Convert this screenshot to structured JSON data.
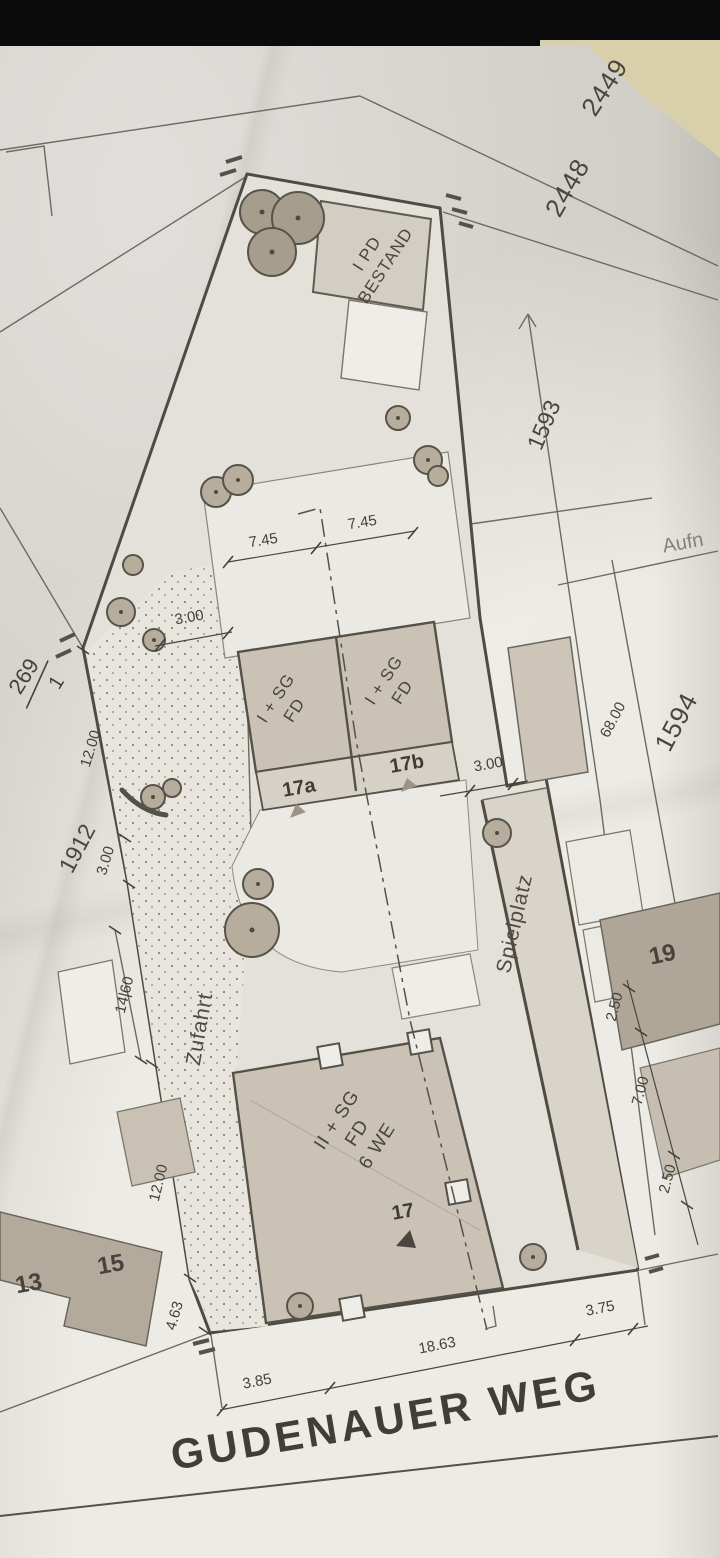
{
  "plan": {
    "street": "GUDENAUER WEG",
    "areas": {
      "driveway": "Zufahrt",
      "playground": "Spielplatz",
      "margin_note": "Aufn"
    },
    "buildings": {
      "bestand": {
        "l1": "I PD",
        "l2": "BESTAND"
      },
      "h17a": {
        "l1": "I + SG",
        "l2": "FD",
        "no": "17a"
      },
      "h17b": {
        "l1": "I + SG",
        "l2": "FD",
        "no": "17b"
      },
      "h17": {
        "l1": "II + SG",
        "l2": "FD",
        "l3": "6 WE",
        "no": "17"
      },
      "h19": {
        "no": "19"
      },
      "h13": {
        "no": "13"
      },
      "h15": {
        "no": "15"
      }
    },
    "parcels": {
      "p2449": "2449",
      "p2448": "2448",
      "p1593": "1593",
      "p1594": "1594",
      "p1912": "1912",
      "p269_num": "269",
      "p269_den": "1"
    },
    "dims": {
      "d745a": "7.45",
      "d745b": "7.45",
      "d300a": "3.00",
      "d300b": "3.00",
      "d300c": "3.00",
      "d1200a": "12.00",
      "d1200b": "12.00",
      "d1460": "14|60",
      "d463": "4.63",
      "d385": "3.85",
      "d1863": "18.63",
      "d375": "3.75",
      "d250a": "2.50",
      "d700": "7.00",
      "d250b": "2.50",
      "d6800": "68.00"
    },
    "colors": {
      "paper": "#edebe5",
      "desk": "#d8d0ab",
      "top_band": "#0b0b0b",
      "plot_line": "#4f4b43",
      "building_fill": "#c9c2b5",
      "neighbor_dark": "#b0a697"
    }
  }
}
